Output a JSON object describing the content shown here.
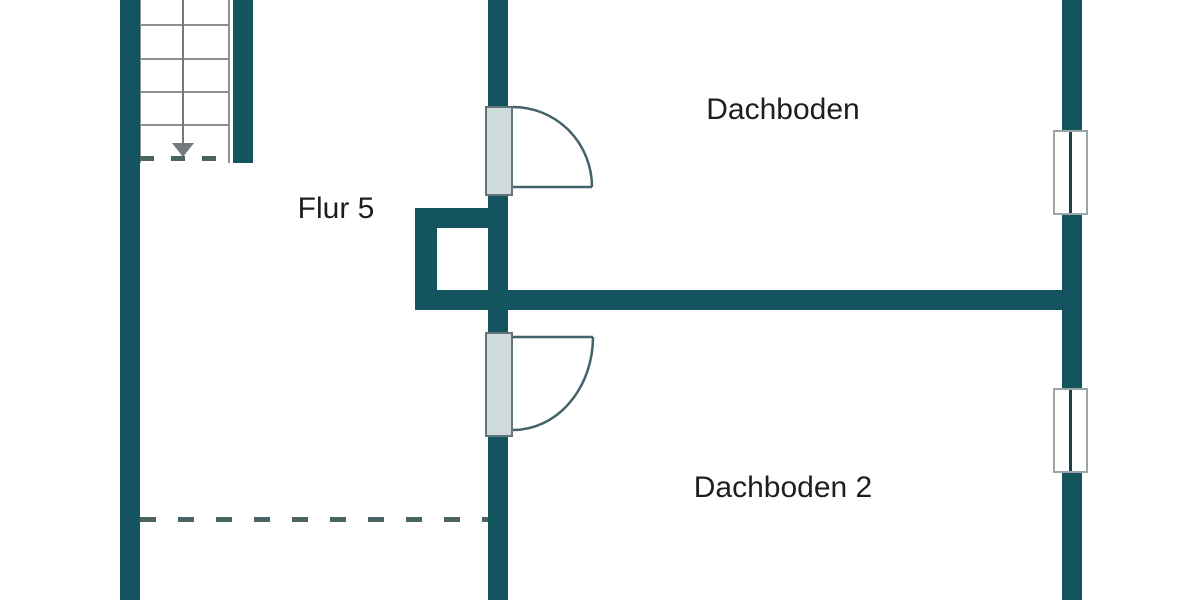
{
  "drawing": {
    "kind": "floor-plan",
    "rooms": [
      {
        "name": "Dachboden"
      },
      {
        "name": "Flur 5"
      },
      {
        "name": "Dachboden 2"
      }
    ],
    "symbols": {
      "stairs": "staircase with down-arrow, 4 treads, dashed cut line",
      "doors": "2 hinged doors with quarter-circle swing arcs on center wall",
      "windows": "2 double-line windows in right exterior wall",
      "chimney": "hollow square shaft at center wall",
      "knee_wall": "dashed attic knee-wall line, lower-left room"
    },
    "colors": {
      "wall": "#14545e",
      "leaf": "#cfdadc",
      "leaf_outline": "#5f7578",
      "gray_line": "#8a8f90",
      "arrow": "#737a7b",
      "dash": "#4a6363",
      "text": "#1e1e1e",
      "win_frame": "#9aa6a8",
      "win_center": "#1d4249",
      "swing": "#44626a"
    }
  }
}
